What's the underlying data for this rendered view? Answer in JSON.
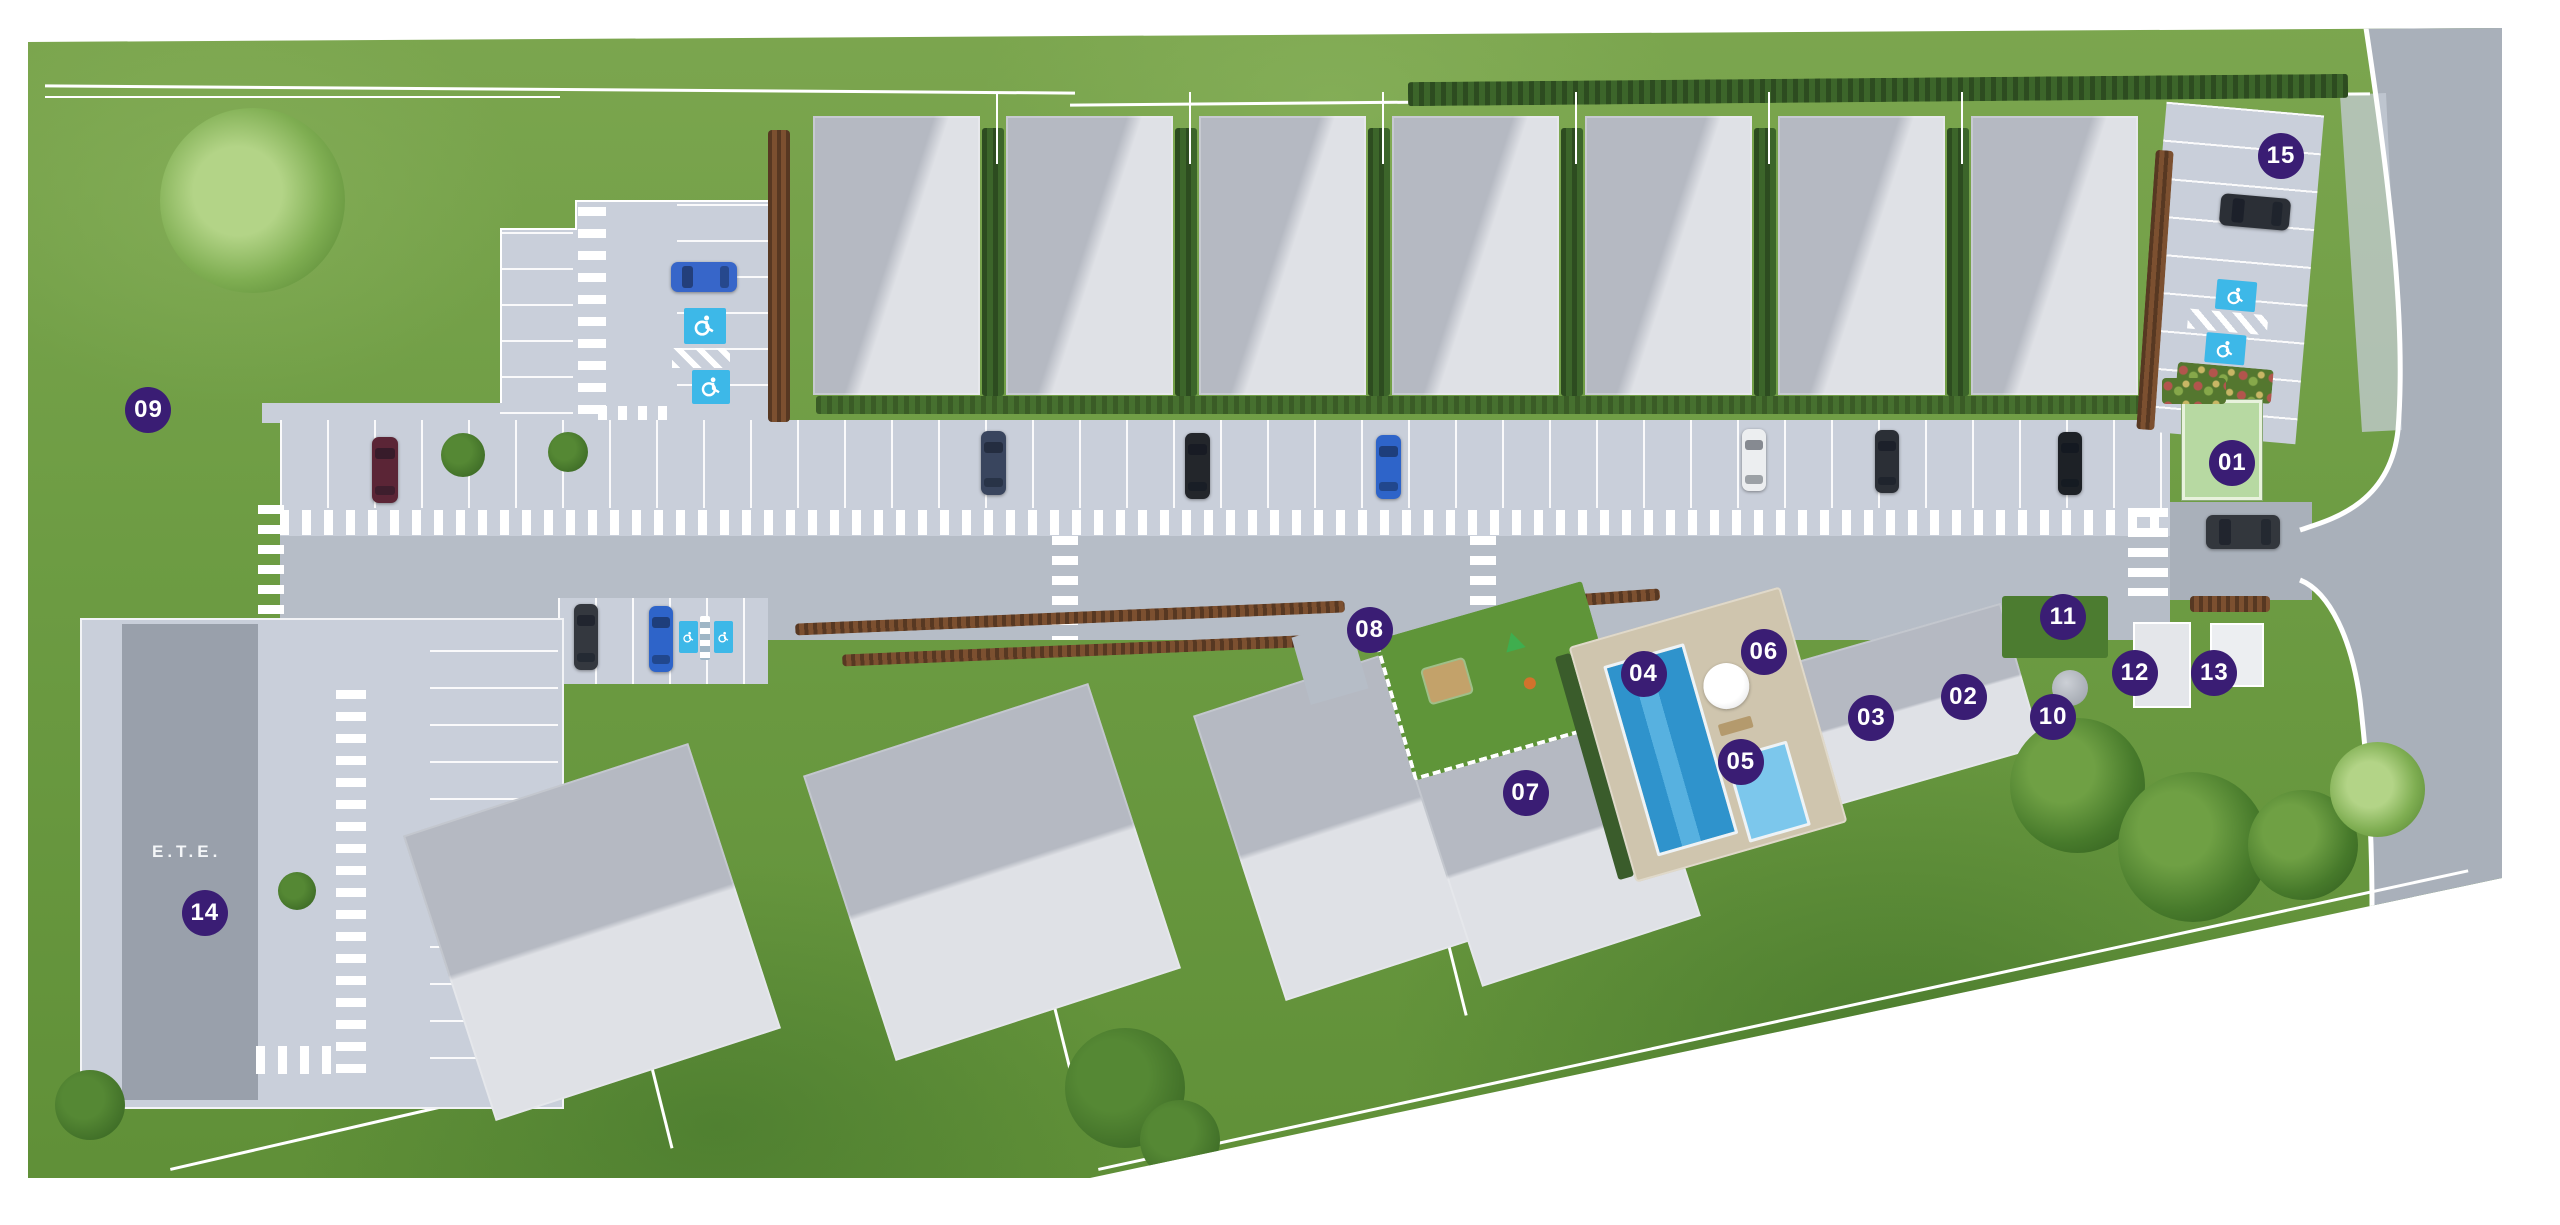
{
  "plan": {
    "ete_label": "E.T.E.",
    "markers": [
      {
        "id": "01",
        "label": "01",
        "x_pct": 87.2,
        "y_pct": 37.8
      },
      {
        "id": "02",
        "label": "02",
        "x_pct": 76.7,
        "y_pct": 56.9
      },
      {
        "id": "03",
        "label": "03",
        "x_pct": 73.1,
        "y_pct": 58.6
      },
      {
        "id": "04",
        "label": "04",
        "x_pct": 64.2,
        "y_pct": 55.0
      },
      {
        "id": "05",
        "label": "05",
        "x_pct": 68.0,
        "y_pct": 62.2
      },
      {
        "id": "06",
        "label": "06",
        "x_pct": 68.9,
        "y_pct": 53.2
      },
      {
        "id": "07",
        "label": "07",
        "x_pct": 59.6,
        "y_pct": 64.7
      },
      {
        "id": "08",
        "label": "08",
        "x_pct": 53.5,
        "y_pct": 51.4
      },
      {
        "id": "09",
        "label": "09",
        "x_pct": 5.8,
        "y_pct": 33.5
      },
      {
        "id": "10",
        "label": "10",
        "x_pct": 80.2,
        "y_pct": 58.5
      },
      {
        "id": "11",
        "label": "11",
        "x_pct": 80.6,
        "y_pct": 50.4
      },
      {
        "id": "12",
        "label": "12",
        "x_pct": 83.4,
        "y_pct": 54.9
      },
      {
        "id": "13",
        "label": "13",
        "x_pct": 86.5,
        "y_pct": 54.9
      },
      {
        "id": "14",
        "label": "14",
        "x_pct": 8.0,
        "y_pct": 74.5
      },
      {
        "id": "15",
        "label": "15",
        "x_pct": 89.1,
        "y_pct": 12.7
      }
    ],
    "icons": {
      "accessible_parking": "wheelchair-icon",
      "marker_pin": "numbered-circle-badge"
    },
    "colors": {
      "marker_purple": "#3a1d74",
      "accessible_blue": "#3db8e8",
      "pool_blue": "#3f9fd4",
      "grass_green": "#6d9c43",
      "road_gray": "#a9b0ba",
      "roof_light": "#dfe1e6",
      "roof_dark": "#b5b9c2",
      "hedge_green": "#3c652a",
      "hedge_rust": "#7c5030",
      "utility_box_green": "#b7d9a2",
      "pool_deck_tan": "#cfc5ae"
    }
  }
}
